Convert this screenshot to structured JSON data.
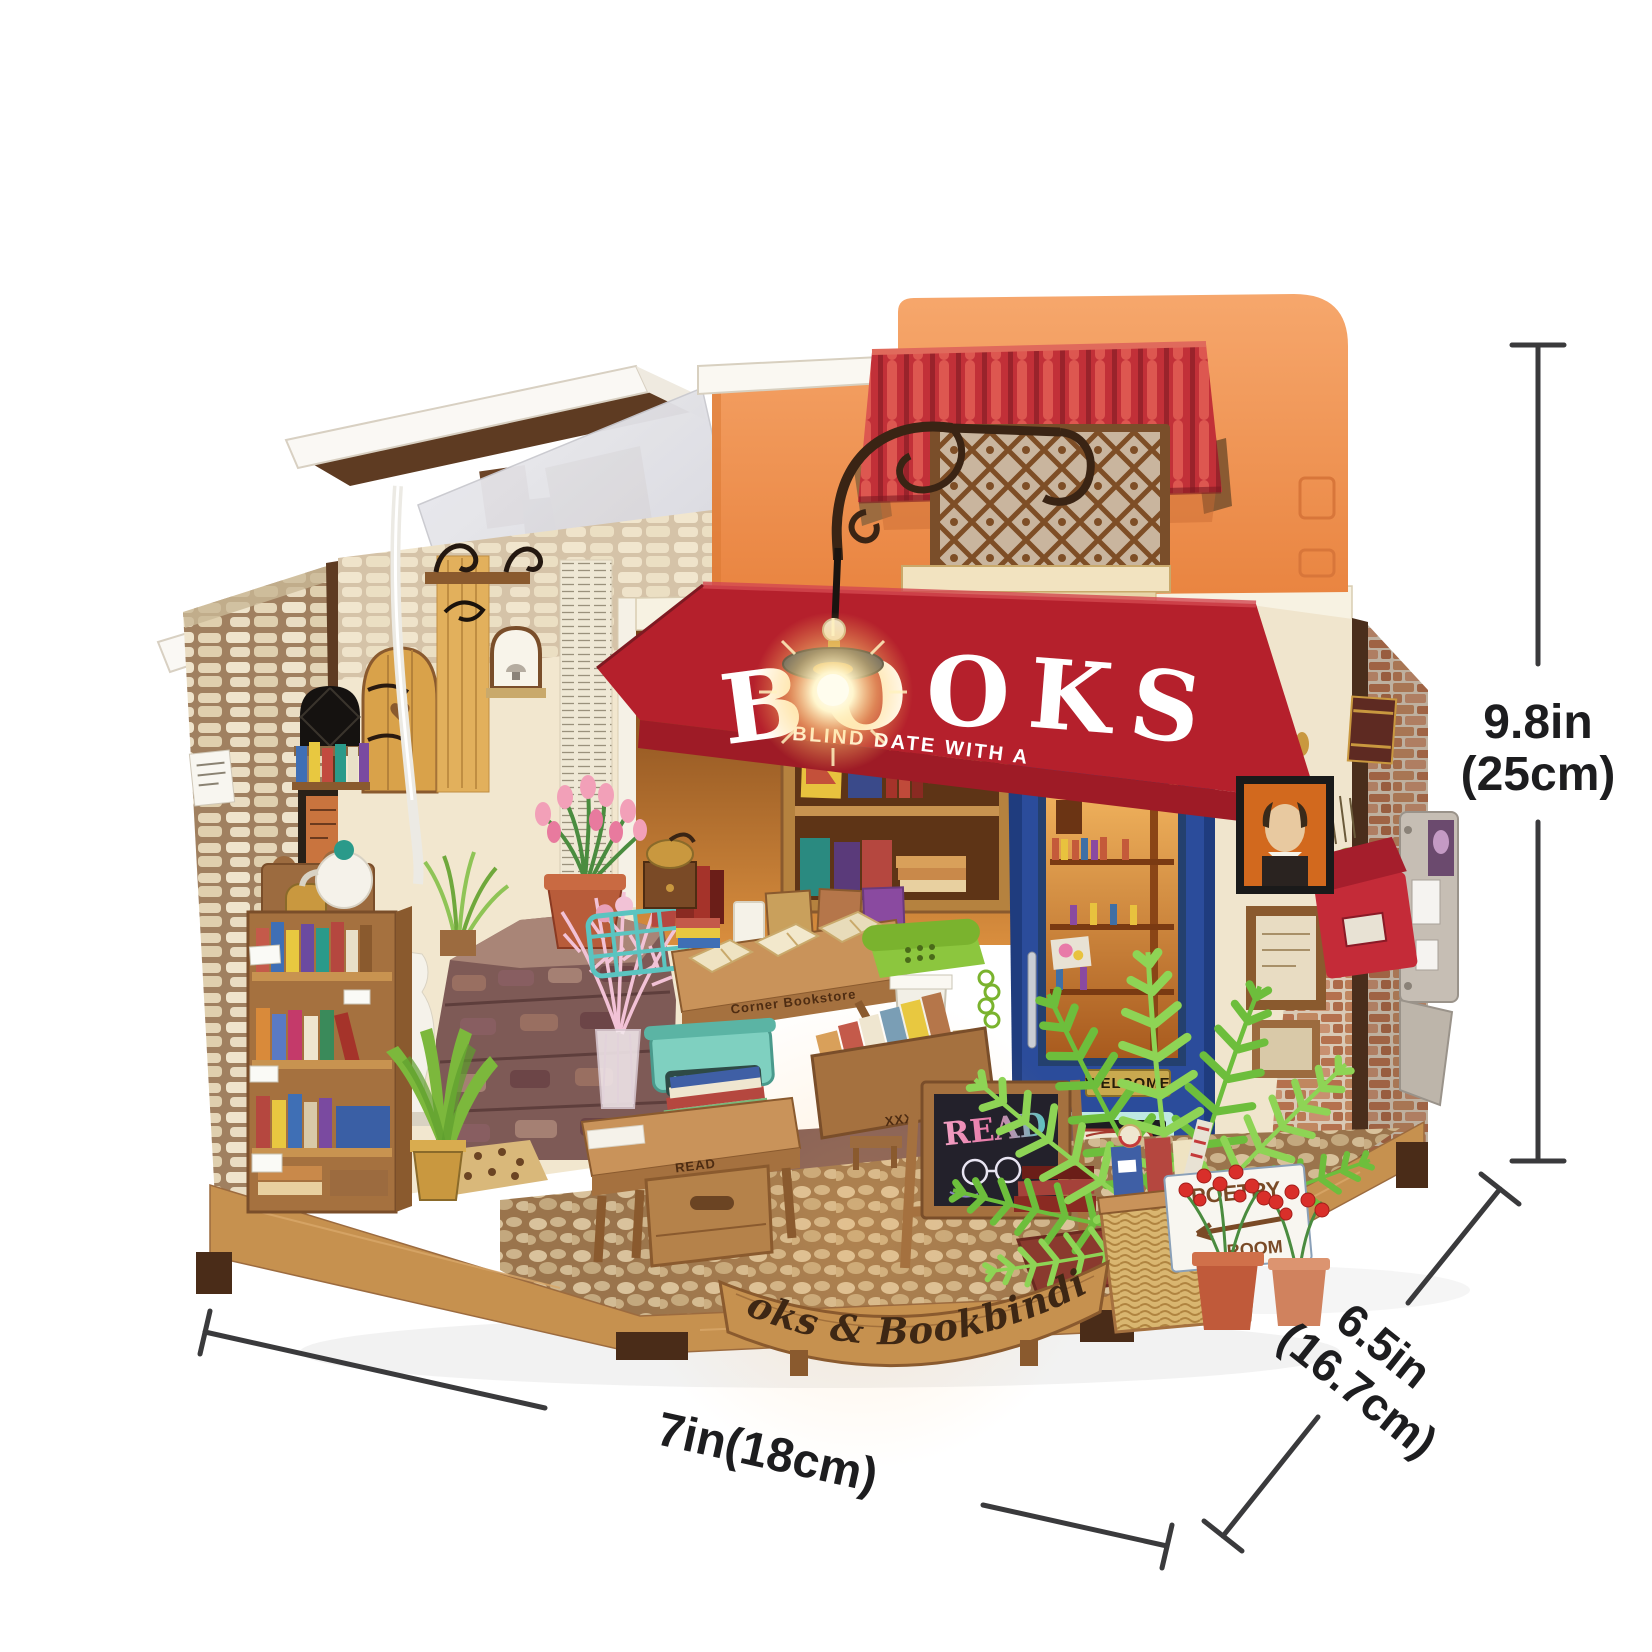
{
  "product": {
    "awning_title": "BOOKS",
    "awning_subtitle": "BLIND DATE WITH A BOOK",
    "door_plaque": "WELCOME",
    "open_sign": "OPEN",
    "poetry_line1": "POETRY",
    "poetry_line2": "ROOM",
    "chalkboard_word": "READ",
    "table_engraving": "READ",
    "display_engraving": "Corner Bookstore",
    "base_banner": "Books & Bookbinding"
  },
  "dimensions": {
    "height_in": "9.8in",
    "height_cm": "(25cm)",
    "depth_in": "6.5in",
    "depth_cm": "(16.7cm)",
    "width_label": "7in(18cm)"
  },
  "colors": {
    "facade_orange": "#f0955b",
    "roof_red": "#c23038",
    "awning_red": "#b5202c",
    "door_blue": "#2b4c9b",
    "base_wood": "#c6914f",
    "fern_green": "#7cc242",
    "dimension_line": "#3a3a3c"
  }
}
